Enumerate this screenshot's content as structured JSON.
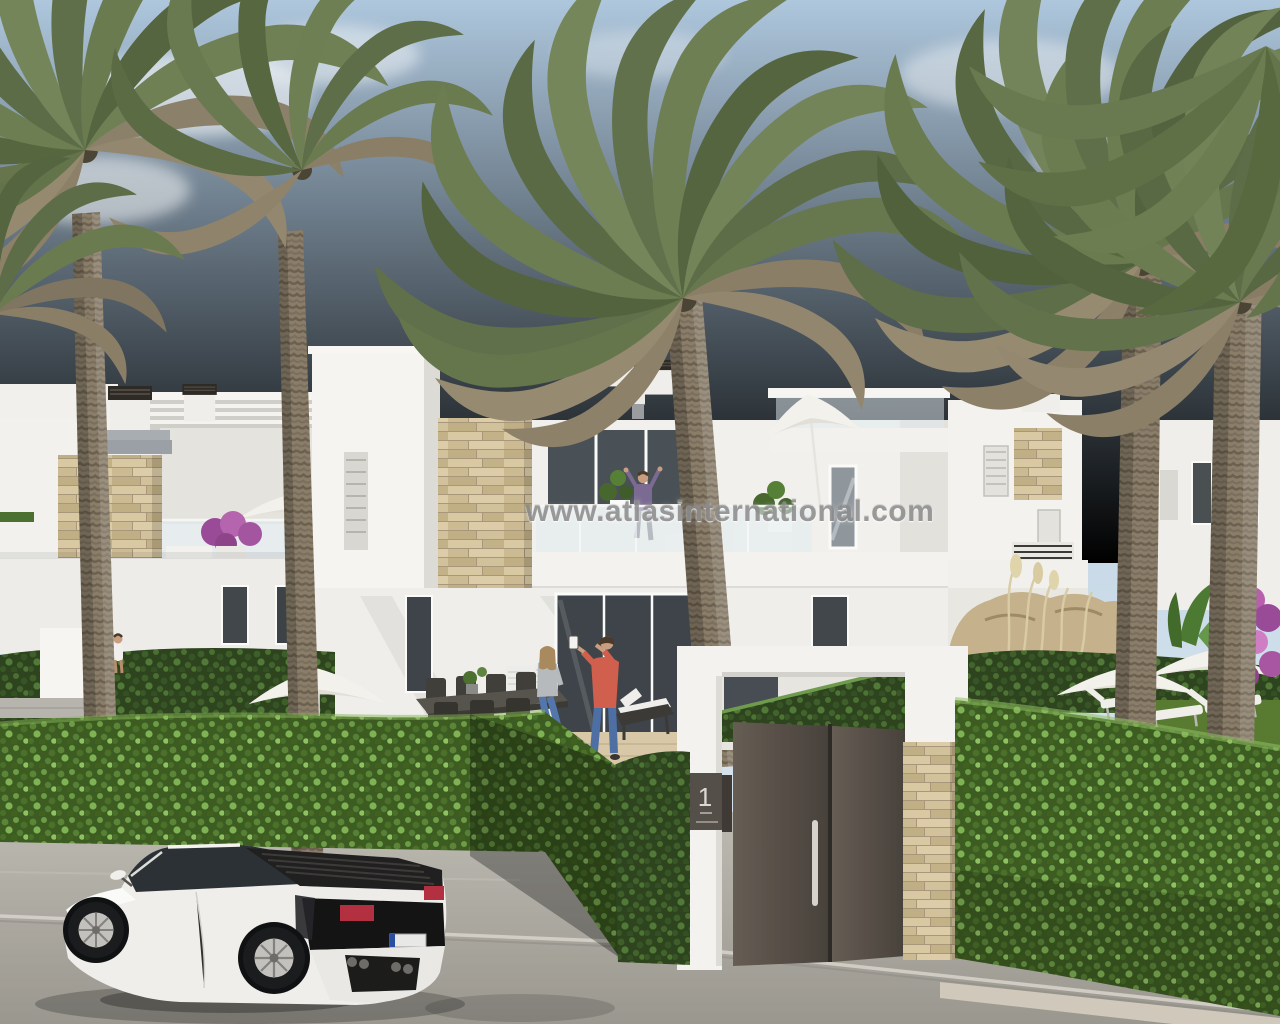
{
  "watermark": {
    "text": "www.atlasinternational.com"
  },
  "gate": {
    "sign_number": "1"
  },
  "scene": {
    "type": "architectural-render",
    "setting": "New-build white Mediterranean townhouses with roof terraces, date palms, clipped hedges, landscaped garden and a white sports car parked on the street",
    "objects": [
      "two-storey white townhouses with roof terraces",
      "date palm trees",
      "clipped box hedges",
      "entrance gate with dark double doors and number plaque",
      "stone-clad pillars",
      "white sports car",
      "outdoor dining table with chairs",
      "sun parasols and sun loungers",
      "people on the terraces"
    ]
  },
  "palette": {
    "sky_top": "#b1c9de",
    "sky_horizon": "#dde8f0",
    "facade_white": "#f4f3f0",
    "facade_shadow": "#d6d5d0",
    "stone_cladding": "#cdbc95",
    "hedge_dark": "#33491f",
    "hedge_light": "#4e7030",
    "palm_green": "#6b7a50",
    "palm_dry": "#8e8269",
    "palm_trunk": "#8a7d68",
    "gate_door": "#57504a",
    "road": "#aeaba4",
    "car_body": "#efeeeb",
    "taillight_red": "#b23040",
    "bougainvillea": "#b465ae"
  }
}
